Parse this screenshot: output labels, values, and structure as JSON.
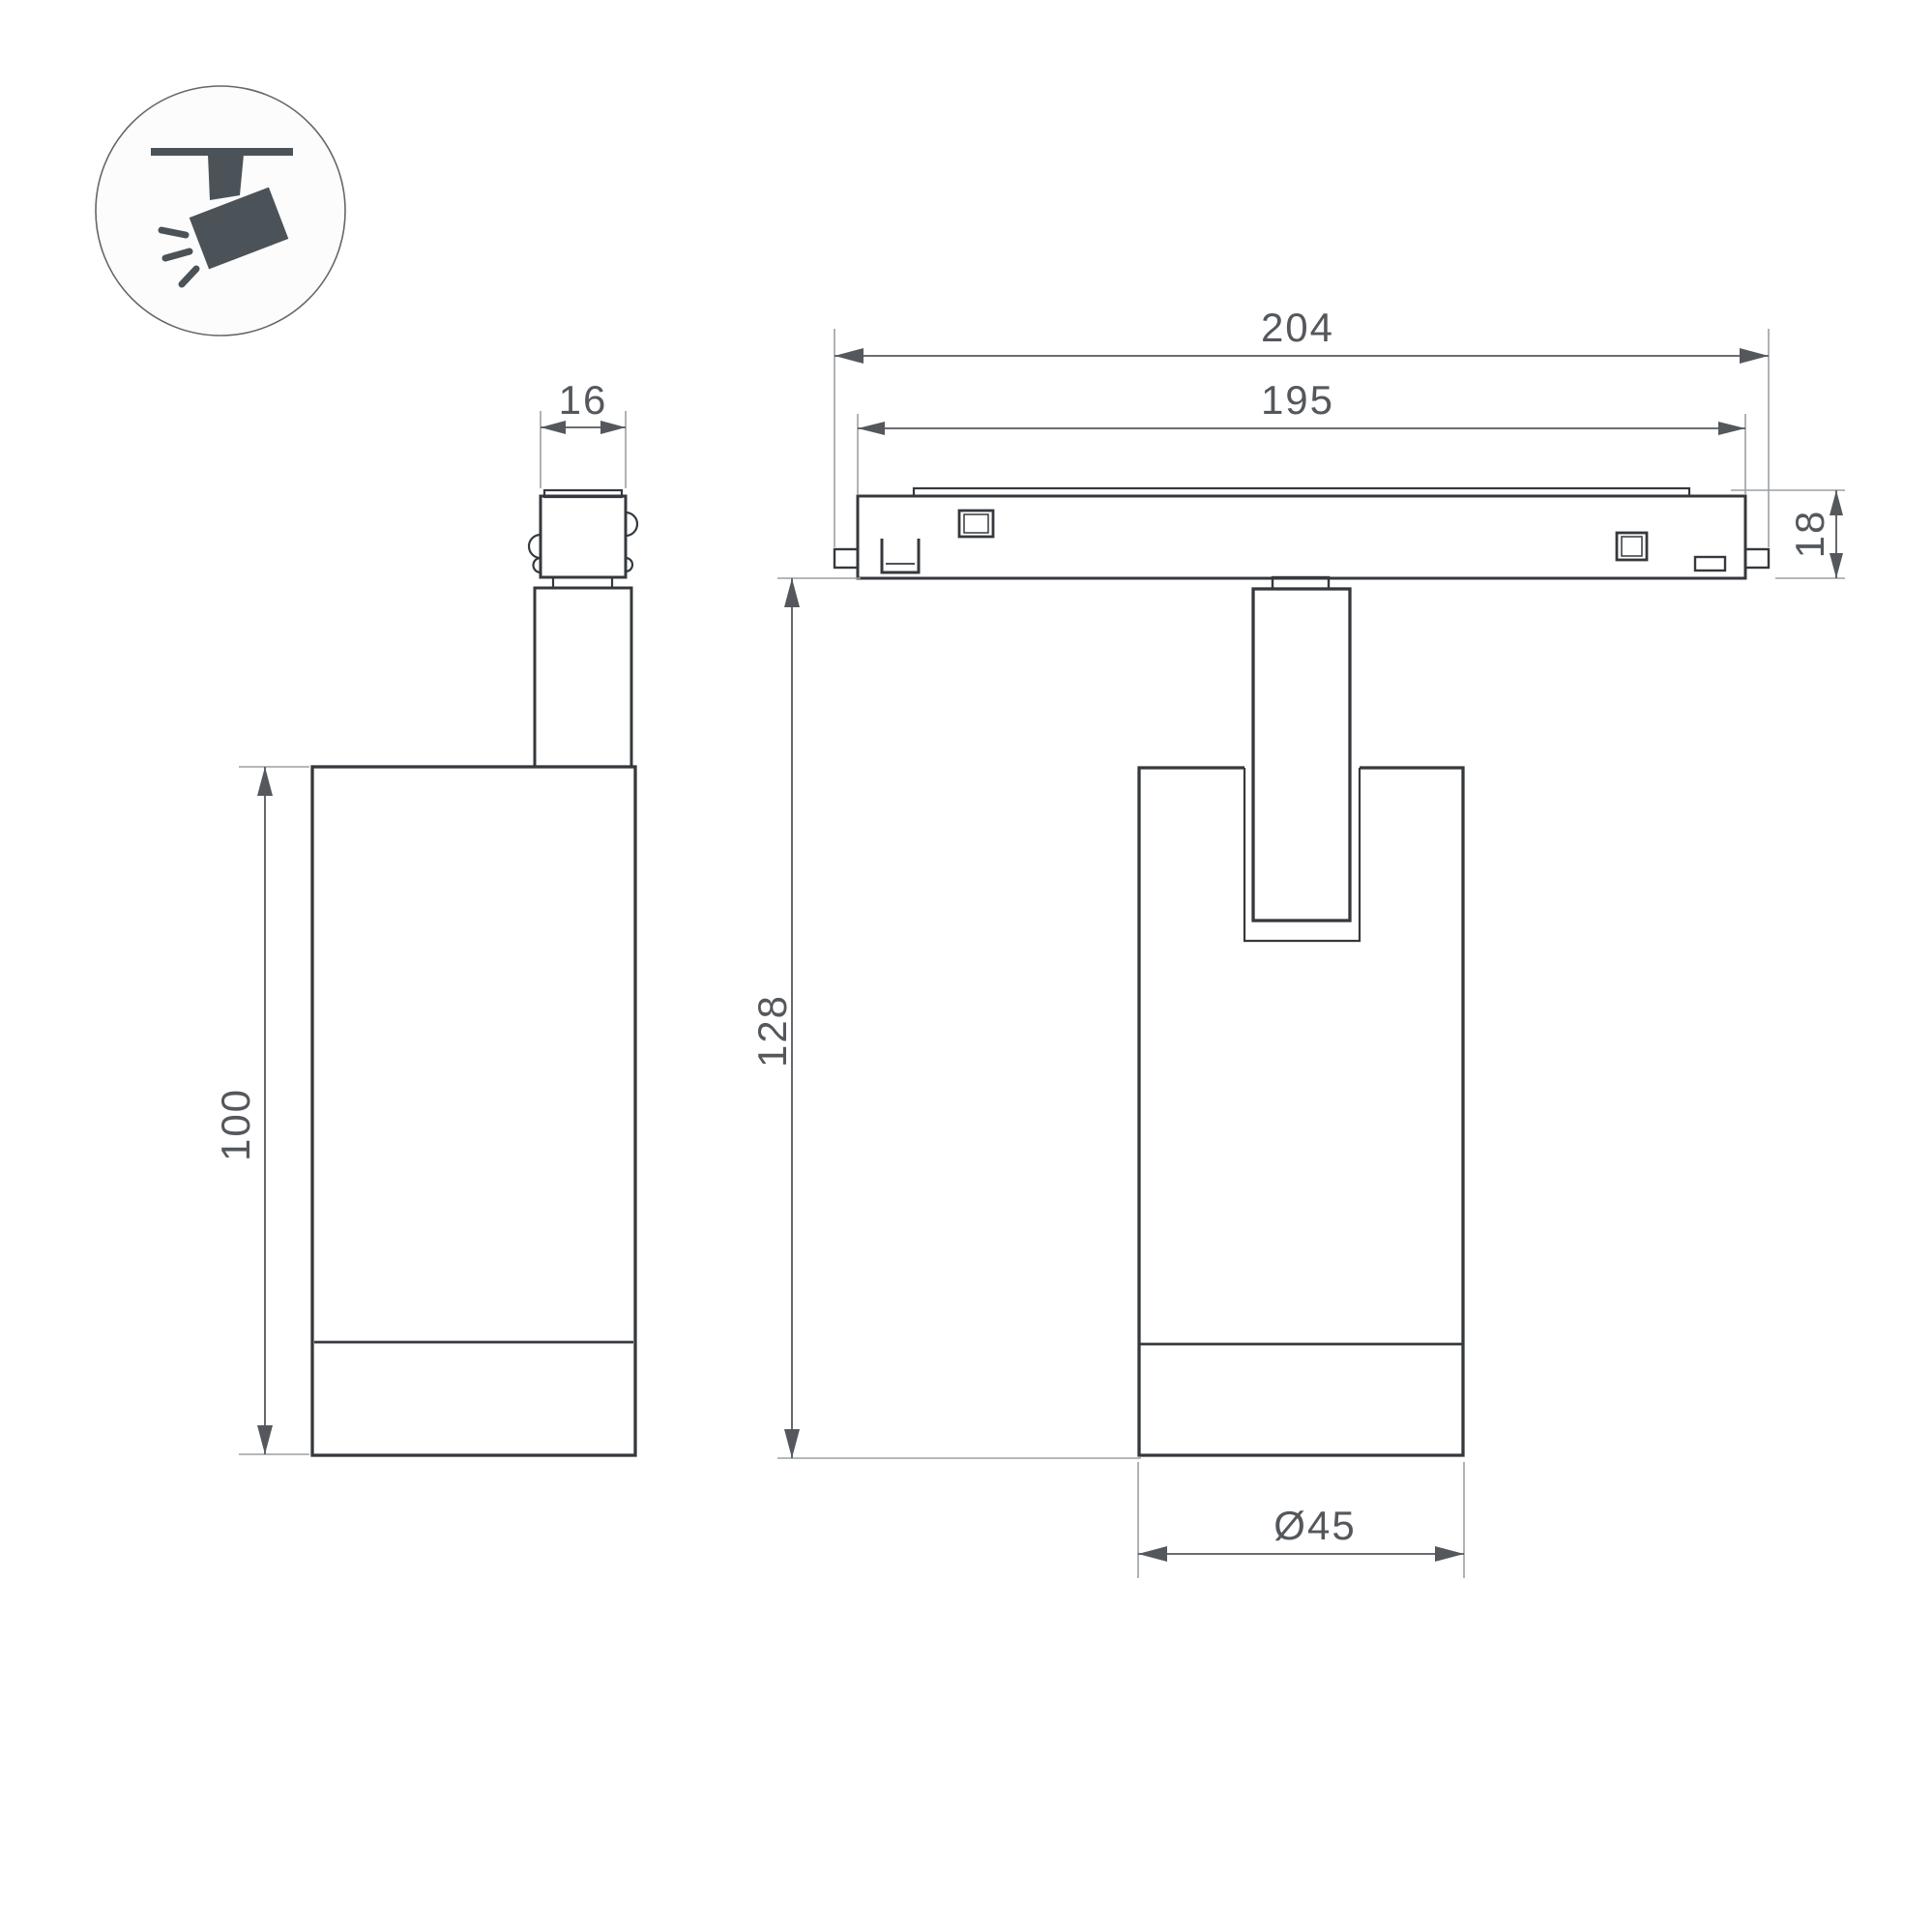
{
  "icon": {
    "name": "track-spotlight-icon",
    "parts": [
      "ceiling-track-bar",
      "mount-stem",
      "spotlight-head",
      "light-rays"
    ]
  },
  "views": {
    "side": {
      "name": "side-view"
    },
    "front": {
      "name": "front-view-on-track"
    }
  },
  "dimensions": {
    "track_length_outer": {
      "value": "204"
    },
    "track_length_inner": {
      "value": "195"
    },
    "adapter_width": {
      "value": "16"
    },
    "track_height": {
      "value": "18"
    },
    "body_height": {
      "value": "100"
    },
    "overall_height": {
      "value": "128"
    },
    "body_diameter": {
      "value": "Ø45"
    }
  },
  "colors": {
    "outline": "#35393d",
    "dim": "#54585c",
    "ext": "#9aa0a4",
    "icon": "#4b5258",
    "bg": "#ffffff",
    "icon_bg": "#fcfcfc"
  }
}
